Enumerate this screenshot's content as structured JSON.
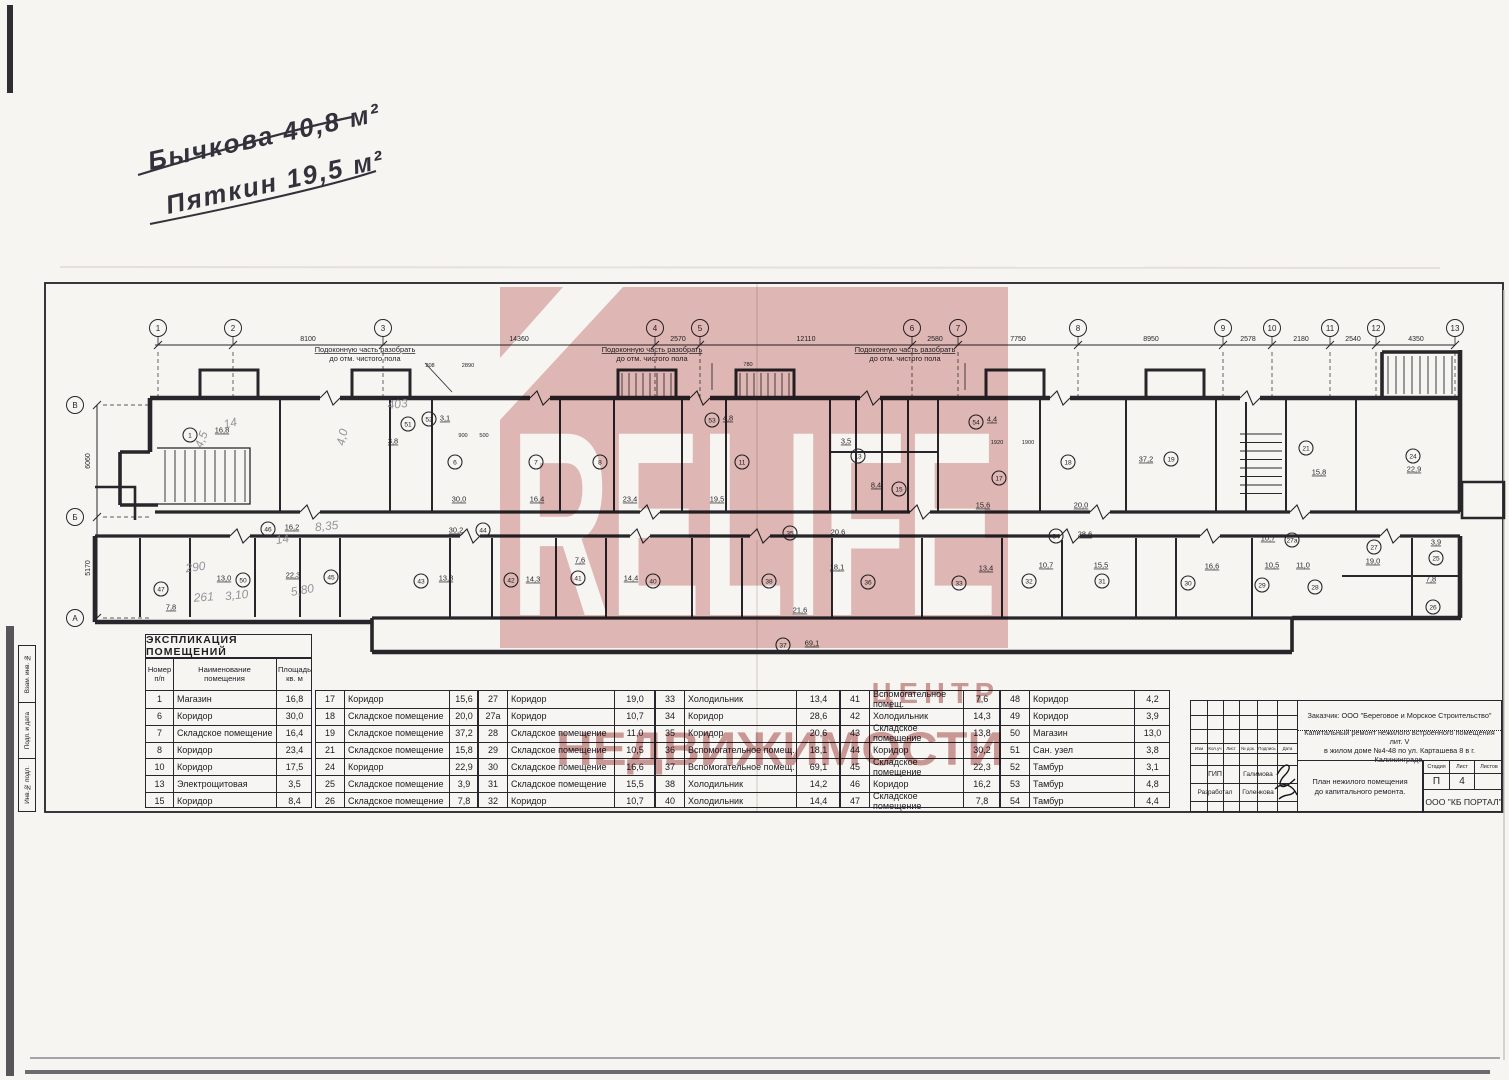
{
  "handwriting": {
    "line1": "Бычкова 40,8 м²",
    "line2": "Пяткин 19,5 м²"
  },
  "watermark": {
    "brand": "RELIFE",
    "line1": "ЦЕНТР",
    "line2": "НЕДВИЖИМОСТИ",
    "pink": "#e5bcbc",
    "text_pink": "#cf9898"
  },
  "plan": {
    "axes_top": [
      {
        "label": "1",
        "x": 158
      },
      {
        "label": "2",
        "x": 233
      },
      {
        "label": "3",
        "x": 383
      },
      {
        "label": "4",
        "x": 655
      },
      {
        "label": "5",
        "x": 700
      },
      {
        "label": "6",
        "x": 912
      },
      {
        "label": "7",
        "x": 958
      },
      {
        "label": "8",
        "x": 1078
      },
      {
        "label": "9",
        "x": 1223
      },
      {
        "label": "10",
        "x": 1272
      },
      {
        "label": "11",
        "x": 1330
      },
      {
        "label": "12",
        "x": 1376
      },
      {
        "label": "13",
        "x": 1455
      }
    ],
    "dims_top": [
      {
        "text": "8100",
        "x": 308
      },
      {
        "text": "14360",
        "x": 519
      },
      {
        "text": "2570",
        "x": 678
      },
      {
        "text": "12110",
        "x": 806
      },
      {
        "text": "2580",
        "x": 935
      },
      {
        "text": "7750",
        "x": 1018
      },
      {
        "text": "8950",
        "x": 1151
      },
      {
        "text": "2578",
        "x": 1248
      },
      {
        "text": "2180",
        "x": 1301
      },
      {
        "text": "2540",
        "x": 1353
      },
      {
        "text": "4350",
        "x": 1416
      }
    ],
    "axes_left": [
      {
        "label": "В",
        "y": 405
      },
      {
        "label": "Б",
        "y": 517
      },
      {
        "label": "А",
        "y": 618
      }
    ],
    "dims_left": [
      {
        "text": "6060",
        "y": 461
      },
      {
        "text": "5170",
        "y": 568
      }
    ],
    "annotation": {
      "line1": "Подоконную часть разобрать",
      "line2": "до отм. чистого пола",
      "positions": [
        {
          "x": 365,
          "lx": 452,
          "ly": 392
        },
        {
          "x": 652,
          "lx": 712,
          "ly": 390
        },
        {
          "x": 905,
          "lx": 965,
          "ly": 390
        }
      ]
    },
    "rooms": [
      [
        "1",
        "16,8",
        190,
        435,
        222,
        430
      ],
      [
        "6",
        "30,0",
        455,
        462,
        459,
        499
      ],
      [
        "7",
        "16,4",
        536,
        462,
        537,
        499
      ],
      [
        "8",
        "23,4",
        600,
        462,
        630,
        499
      ],
      [
        "11",
        "19,5",
        742,
        462,
        717,
        499
      ],
      [
        "13",
        "3,5",
        858,
        456,
        846,
        441
      ],
      [
        "15",
        "8,4",
        899,
        489,
        876,
        485
      ],
      [
        "17",
        "15,6",
        999,
        478,
        983,
        505
      ],
      [
        "18",
        "20,0",
        1068,
        462,
        1081,
        505
      ],
      [
        "19",
        "37,2",
        1171,
        459,
        1146,
        459
      ],
      [
        "21",
        "15,8",
        1306,
        448,
        1319,
        472
      ],
      [
        "24",
        "22,9",
        1413,
        456,
        1414,
        469
      ],
      [
        "51",
        "3,8",
        408,
        424,
        393,
        441
      ],
      [
        "52",
        "3,1",
        429,
        419,
        445,
        418
      ],
      [
        "53",
        "4,8",
        712,
        420,
        728,
        418
      ],
      [
        "54",
        "4,4",
        976,
        422,
        992,
        419
      ],
      [
        "44",
        "30,2",
        483,
        530,
        456,
        530
      ],
      [
        "46",
        "16,2",
        268,
        529,
        292,
        527
      ],
      [
        "35",
        "20,6",
        790,
        533,
        838,
        532
      ],
      [
        "34",
        "28,6",
        1056,
        536,
        1085,
        534
      ],
      [
        "27",
        "19,0",
        1374,
        547,
        1373,
        561
      ],
      [
        "27а",
        "10,7",
        1292,
        540,
        1268,
        538
      ],
      [
        "43",
        "13,8",
        421,
        581,
        446,
        578
      ],
      [
        "42",
        "14,3",
        511,
        580,
        533,
        579
      ],
      [
        "41",
        "7,6",
        578,
        578,
        580,
        560
      ],
      [
        "40",
        "14,4",
        653,
        581,
        631,
        578
      ],
      [
        "38",
        "21,6",
        769,
        581,
        800,
        610
      ],
      [
        "36",
        "18,1",
        868,
        582,
        837,
        567
      ],
      [
        "33",
        "13,4",
        959,
        583,
        986,
        568
      ],
      [
        "32",
        "10,7",
        1029,
        581,
        1046,
        565
      ],
      [
        "31",
        "15,5",
        1102,
        581,
        1101,
        565
      ],
      [
        "30",
        "16,6",
        1188,
        583,
        1212,
        566
      ],
      [
        "29",
        "10,5",
        1262,
        585,
        1272,
        565
      ],
      [
        "28",
        "11,0",
        1315,
        587,
        1303,
        565
      ],
      [
        "25",
        "3,9",
        1436,
        558,
        1436,
        542
      ],
      [
        "26",
        "7,8",
        1433,
        607,
        1431,
        579
      ],
      [
        "47",
        "7,8",
        161,
        589,
        171,
        607
      ],
      [
        "50",
        "13,0",
        243,
        580,
        224,
        578
      ],
      [
        "45",
        "22,3",
        331,
        577,
        293,
        575
      ],
      [
        "37",
        "69,1",
        783,
        645,
        812,
        643
      ]
    ],
    "small_dims": [
      {
        "text": "208",
        "x": 430,
        "y": 367
      },
      {
        "text": "2890",
        "x": 468,
        "y": 367
      },
      {
        "text": "780",
        "x": 748,
        "y": 366
      },
      {
        "text": "900",
        "x": 463,
        "y": 437
      },
      {
        "text": "500",
        "x": 484,
        "y": 437
      },
      {
        "text": "1920",
        "x": 997,
        "y": 444
      },
      {
        "text": "1900",
        "x": 1028,
        "y": 444
      }
    ],
    "pencil_notes": [
      {
        "text": "403",
        "x": 398,
        "y": 408,
        "r": -6
      },
      {
        "text": "4,0",
        "x": 346,
        "y": 438,
        "r": -78
      },
      {
        "text": "14",
        "x": 231,
        "y": 427,
        "r": -12
      },
      {
        "text": "4,5",
        "x": 205,
        "y": 441,
        "r": -70
      },
      {
        "text": "8,35",
        "x": 327,
        "y": 530,
        "r": -6
      },
      {
        "text": "14",
        "x": 283,
        "y": 543,
        "r": -10
      },
      {
        "text": "290",
        "x": 196,
        "y": 571,
        "r": -8
      },
      {
        "text": "261",
        "x": 204,
        "y": 601,
        "r": -4
      },
      {
        "text": "3,10",
        "x": 237,
        "y": 599,
        "r": -6
      },
      {
        "text": "5,80",
        "x": 303,
        "y": 594,
        "r": -10
      }
    ]
  },
  "explication": {
    "title": "ЭКСПЛИКАЦИЯ ПОМЕЩЕНИЙ",
    "headers": {
      "num": "Номер\nп/п",
      "name": "Наименование\nпомещения",
      "area": "Площадь\nкв. м"
    },
    "groups": [
      [
        {
          "n": "1",
          "name": "Магазин",
          "a": "16,8"
        },
        {
          "n": "6",
          "name": "Коридор",
          "a": "30,0"
        },
        {
          "n": "7",
          "name": "Складское помещение",
          "a": "16,4"
        },
        {
          "n": "8",
          "name": "Коридор",
          "a": "23,4"
        },
        {
          "n": "10",
          "name": "Коридор",
          "a": "17,5"
        },
        {
          "n": "13",
          "name": "Электрощитовая",
          "a": "3,5"
        },
        {
          "n": "15",
          "name": "Коридор",
          "a": "8,4"
        }
      ],
      [
        {
          "n": "17",
          "name": "Коридор",
          "a": "15,6"
        },
        {
          "n": "18",
          "name": "Складское помещение",
          "a": "20,0"
        },
        {
          "n": "19",
          "name": "Складское помещение",
          "a": "37,2"
        },
        {
          "n": "21",
          "name": "Складское помещение",
          "a": "15,8"
        },
        {
          "n": "24",
          "name": "Коридор",
          "a": "22,9"
        },
        {
          "n": "25",
          "name": "Складское помещение",
          "a": "3,9"
        },
        {
          "n": "26",
          "name": "Складское помещение",
          "a": "7,8"
        }
      ],
      [
        {
          "n": "27",
          "name": "Коридор",
          "a": "19,0"
        },
        {
          "n": "27а",
          "name": "Коридор",
          "a": "10,7"
        },
        {
          "n": "28",
          "name": "Складское помещение",
          "a": "11,0"
        },
        {
          "n": "29",
          "name": "Складское помещение",
          "a": "10,5"
        },
        {
          "n": "30",
          "name": "Складское помещение",
          "a": "16,6"
        },
        {
          "n": "31",
          "name": "Складское помещение",
          "a": "15,5"
        },
        {
          "n": "32",
          "name": "Коридор",
          "a": "10,7"
        }
      ],
      [
        {
          "n": "33",
          "name": "Холодильник",
          "a": "13,4"
        },
        {
          "n": "34",
          "name": "Коридор",
          "a": "28,6"
        },
        {
          "n": "35",
          "name": "Коридор",
          "a": "20,6"
        },
        {
          "n": "36",
          "name": "Вспомогательное помещ.",
          "a": "18,1"
        },
        {
          "n": "37",
          "name": "Вспомогательное помещ.",
          "a": "69,1"
        },
        {
          "n": "38",
          "name": "Холодильник",
          "a": "14,2"
        },
        {
          "n": "40",
          "name": "Холодильник",
          "a": "14,4"
        }
      ],
      [
        {
          "n": "41",
          "name": "Вспомогательное помещ.",
          "a": "7,6"
        },
        {
          "n": "42",
          "name": "Холодильник",
          "a": "14,3"
        },
        {
          "n": "43",
          "name": "Складское помещение",
          "a": "13,8"
        },
        {
          "n": "44",
          "name": "Коридор",
          "a": "30,2"
        },
        {
          "n": "45",
          "name": "Складское помещение",
          "a": "22,3"
        },
        {
          "n": "46",
          "name": "Коридор",
          "a": "16,2"
        },
        {
          "n": "47",
          "name": "Складское помещение",
          "a": "7,8"
        }
      ],
      [
        {
          "n": "48",
          "name": "Коридор",
          "a": "4,2"
        },
        {
          "n": "49",
          "name": "Коридор",
          "a": "3,9"
        },
        {
          "n": "50",
          "name": "Магазин",
          "a": "13,0"
        },
        {
          "n": "51",
          "name": "Сан. узел",
          "a": "3,8"
        },
        {
          "n": "52",
          "name": "Тамбур",
          "a": "3,1"
        },
        {
          "n": "53",
          "name": "Тамбур",
          "a": "4,8"
        },
        {
          "n": "54",
          "name": "Тамбур",
          "a": "4,4"
        }
      ]
    ]
  },
  "title_block": {
    "customer": "Заказчик:  ООО \"Береговое и Морское Строительство\"",
    "project_line1": "Капитальный ремонт нежилого встроенного помещения лит. V",
    "project_line2": "в жилом доме №4-48 по ул. Карташева 8 в г. Калининграде.",
    "col_headers": [
      "Изм",
      "Кол.уч",
      "Лист",
      "№ док.",
      "Подпись",
      "Дата"
    ],
    "role1": "ГИП",
    "name1": "Галимова",
    "role2": "Разработал",
    "name2": "Голенкова",
    "stage_headers": [
      "Стадия",
      "Лист",
      "Листов"
    ],
    "stage_value": "П",
    "sheet_value": "4",
    "sheets_value": "",
    "drawing_title_line1": "План нежилого помещения",
    "drawing_title_line2": "до капитального ремонта.",
    "company": "ООО \"КБ ПОРТАЛ\""
  },
  "side_strip": {
    "labels": [
      "Взам. инв. №",
      "Подп. и дата",
      "Инв.№ подл."
    ]
  }
}
